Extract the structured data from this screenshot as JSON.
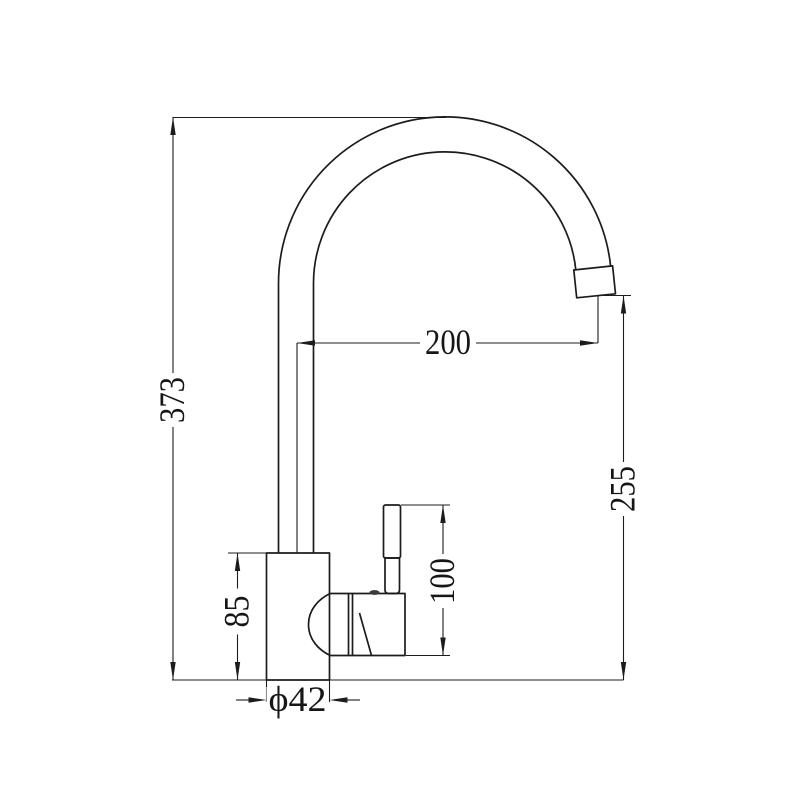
{
  "drawing": {
    "background": "#ffffff",
    "line_color": "#1c1c1c",
    "dimensions": {
      "overall_height": "373",
      "spout_reach": "200",
      "outlet_height": "255",
      "handle_height": "100",
      "body_height": "85",
      "base_diameter": "ϕ42"
    }
  }
}
